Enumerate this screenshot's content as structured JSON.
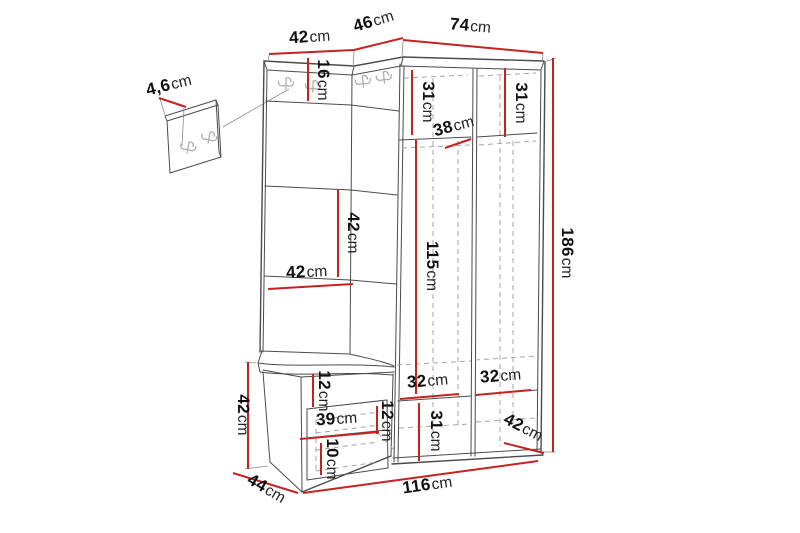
{
  "colors": {
    "dimension": "#c52222",
    "line": "#4b4b4b",
    "dash": "#a5a5a5",
    "leader": "#8c8c8c",
    "hook": "#aeaeae",
    "background": "#ffffff",
    "text": "#111111"
  },
  "icons": {
    "coat_hook": "double-coat-hook-icon"
  },
  "dimensions": {
    "top_section_width": {
      "num": "42",
      "unit": "cm"
    },
    "corner_section_width": {
      "num": "46",
      "unit": "cm"
    },
    "right_section_width": {
      "num": "74",
      "unit": "cm"
    },
    "panel_thickness": {
      "num": "4,6",
      "unit": "cm"
    },
    "hook_panel_height": {
      "num": "16",
      "unit": "cm"
    },
    "upper_compartment_left": {
      "num": "31",
      "unit": "cm"
    },
    "upper_compartment_right": {
      "num": "31",
      "unit": "cm"
    },
    "interior_depth": {
      "num": "38",
      "unit": "cm"
    },
    "wall_panel_height": {
      "num": "42",
      "unit": "cm"
    },
    "wall_panel_width": {
      "num": "42",
      "unit": "cm"
    },
    "interior_height": {
      "num": "115",
      "unit": "cm"
    },
    "total_height": {
      "num": "186",
      "unit": "cm"
    },
    "bench_height": {
      "num": "42",
      "unit": "cm"
    },
    "bench_top_height": {
      "num": "12",
      "unit": "cm"
    },
    "bench_opening_width": {
      "num": "39",
      "unit": "cm"
    },
    "bench_opening_height": {
      "num": "12",
      "unit": "cm"
    },
    "bench_base_height": {
      "num": "10",
      "unit": "cm"
    },
    "bench_depth": {
      "num": "44",
      "unit": "cm"
    },
    "lower_compartment_left": {
      "num": "32",
      "unit": "cm"
    },
    "lower_compartment_right": {
      "num": "32",
      "unit": "cm"
    },
    "lower_compartment_height": {
      "num": "31",
      "unit": "cm"
    },
    "lower_depth": {
      "num": "42",
      "unit": "cm"
    },
    "total_width": {
      "num": "116",
      "unit": "cm"
    }
  }
}
